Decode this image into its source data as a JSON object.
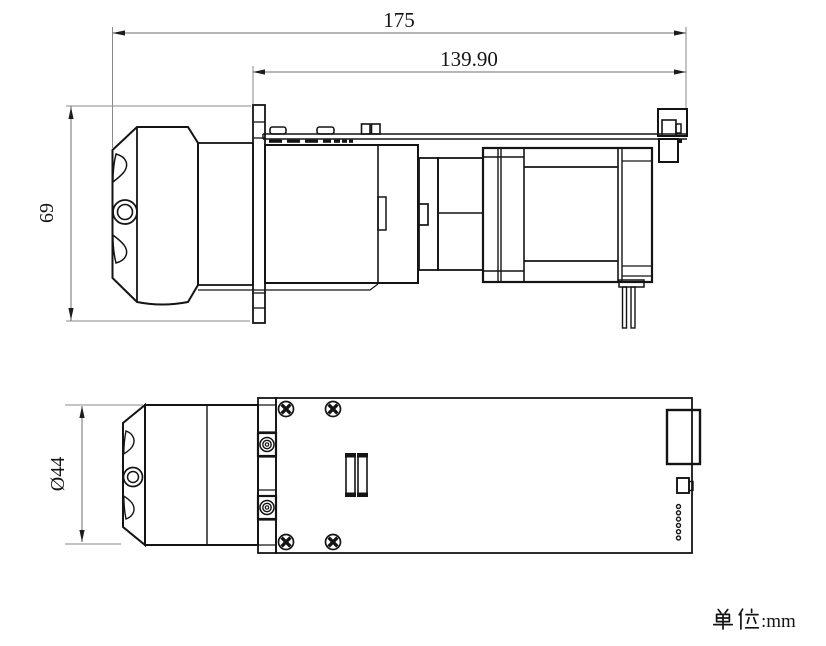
{
  "dimensions": {
    "overall_length": "175",
    "upper_length": "139.90",
    "height": "69",
    "diameter": "Ø44"
  },
  "unit_note": {
    "full_text": "单位:mm",
    "cjk_prefix": "单位",
    "suffix": ":mm"
  },
  "colors": {
    "background": "#ffffff",
    "object_line": "#141414",
    "dimension_line": "#6e6e6e",
    "extension_line": "#8a8a8a",
    "arrow": "#1c1c1c",
    "text": "#141414"
  }
}
